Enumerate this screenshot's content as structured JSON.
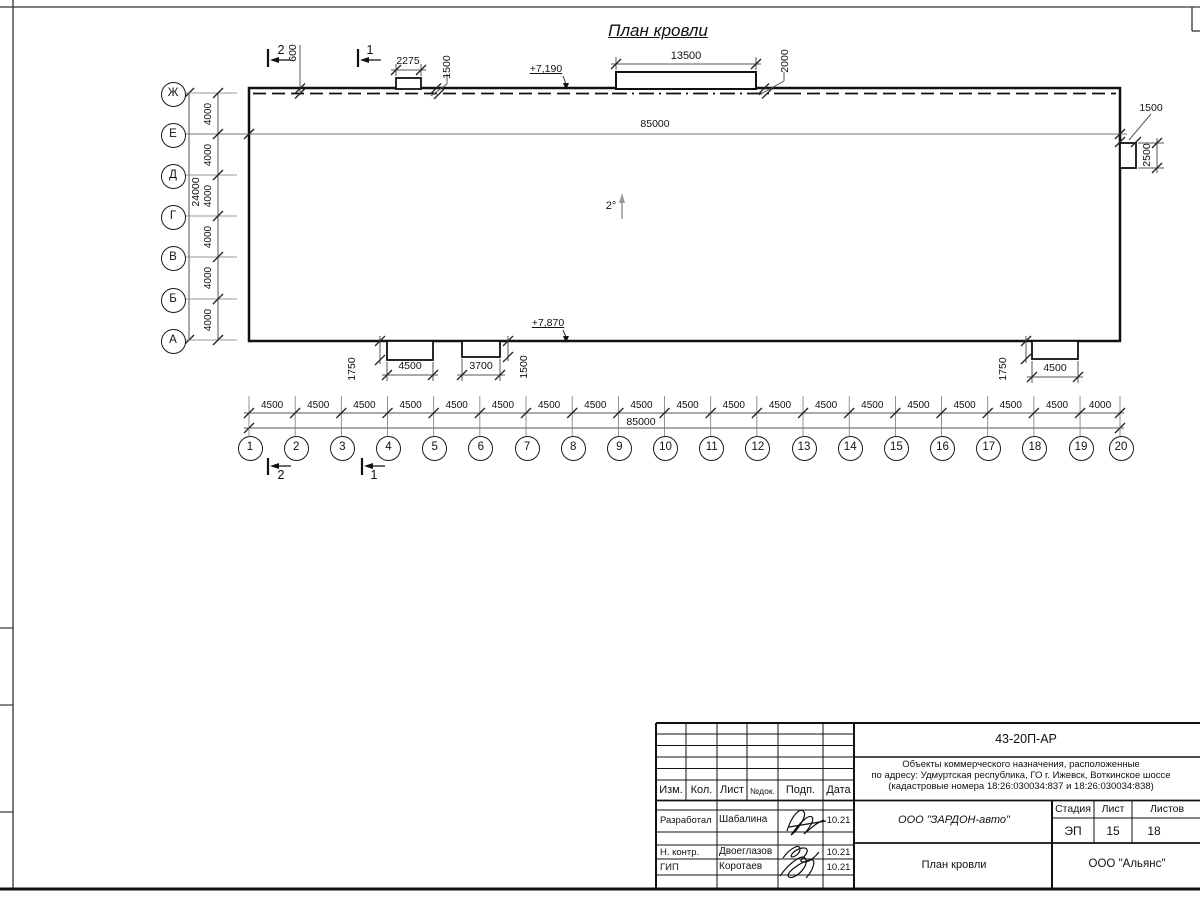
{
  "sheet": {
    "title": "План кровли",
    "slope": "2°"
  },
  "axes": {
    "horizontal": [
      "1",
      "2",
      "3",
      "4",
      "5",
      "6",
      "7",
      "8",
      "9",
      "10",
      "11",
      "12",
      "13",
      "14",
      "15",
      "16",
      "17",
      "18",
      "19",
      "20"
    ],
    "vertical": [
      "Ж",
      "Е",
      "Д",
      "Г",
      "В",
      "Б",
      "А"
    ],
    "h_spacings": [
      "4500",
      "4500",
      "4500",
      "4500",
      "4500",
      "4500",
      "4500",
      "4500",
      "4500",
      "4500",
      "4500",
      "4500",
      "4500",
      "4500",
      "4500",
      "4500",
      "4500",
      "4500",
      "4000"
    ],
    "h_total": "85000",
    "v_spacings": [
      "4000",
      "4000",
      "4000",
      "4000",
      "4000",
      "4000"
    ],
    "v_total": "24000"
  },
  "plan": {
    "length": "85000",
    "elevation_top": "+7,190",
    "elevation_bottom": "+7,870",
    "offset_top": "600",
    "canopy_small_width": "2275",
    "canopy_small_height": "1500",
    "canopy_large_width": "13500",
    "canopy_large_height": "2000",
    "right_box_width": "1500",
    "right_box_height": "2500",
    "bottom_box1_width": "4500",
    "bottom_box1_height": "1750",
    "bottom_box2_width": "3700",
    "bottom_box2_height": "1500",
    "bottom_box3_width": "4500",
    "bottom_box3_height": "1750"
  },
  "sections": {
    "s1": "1",
    "s2": "2"
  },
  "title_block": {
    "doc_number": "43-20П-АР",
    "description": {
      "line1": "Объекты коммерческого назначения, расположенные",
      "line2": "по адресу: Удмуртская республика, ГО г. Ижевск, Воткинское шоссе",
      "line3": "(кадастровые номера 18:26:030034:837 и 18:26:030034:838)"
    },
    "columns": {
      "izm": "Изм.",
      "kol": "Кол.",
      "list": "Лист",
      "ndok": "№док.",
      "podp": "Подп.",
      "data": "Дата"
    },
    "rows": [
      {
        "role": "Разработал",
        "name": "Шабалина",
        "date": "10.21"
      },
      {
        "role": "Н. контр.",
        "name": "Двоеглазов",
        "date": "10.21"
      },
      {
        "role": "ГИП",
        "name": "Коротаев",
        "date": "10.21"
      }
    ],
    "company": "ООО \"ЗАРДОН-авто\"",
    "stage_label": "Стадия",
    "sheet_label": "Лист",
    "sheets_label": "Листов",
    "stage": "ЭП",
    "sheet_number": "15",
    "sheets_total": "18",
    "drawing_title": "План кровли",
    "contractor": "ООО \"Альянс\""
  }
}
